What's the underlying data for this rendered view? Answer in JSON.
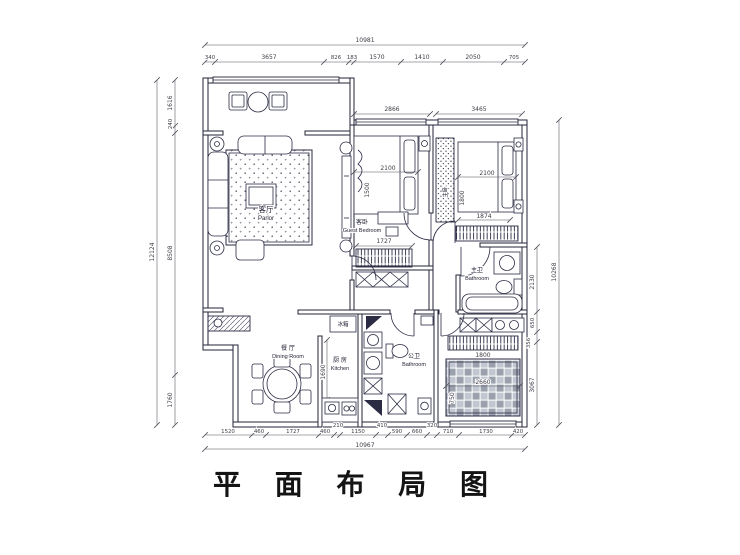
{
  "title": "平 面 布 局 图",
  "colors": {
    "line": "#23233a",
    "dim_text": "#3c3c46",
    "paper": "#ffffff",
    "tatami_dark": "#9aa1ac",
    "tatami_light": "#c2c8d2"
  },
  "rooms": {
    "parlor": {
      "zh": "客厅",
      "en": "Parlor"
    },
    "guest_bedroom": {
      "zh": "客卧",
      "en": "Guest Bedroom"
    },
    "master_bedroom": {
      "zh": "主卧"
    },
    "dining": {
      "zh": "餐 厅",
      "en": "Dining Room"
    },
    "kitchen": {
      "zh": "厨 房",
      "en": "Kitchen"
    },
    "guest_bath": {
      "zh": "公卫",
      "en": "Bathroom"
    },
    "master_bath": {
      "zh": "主卫",
      "en": "Bathroom"
    },
    "fridge_label": "冰箱"
  },
  "dims": {
    "top_total": "10981",
    "top": [
      "340",
      "3657",
      "826",
      "183",
      "1570",
      "1410",
      "2050",
      "705"
    ],
    "left_total": "12124",
    "left": [
      "1616",
      "240",
      "8508",
      "1760"
    ],
    "bottom_total": "10967",
    "bottom": [
      "1520",
      "460",
      "1727",
      "460",
      "210",
      "1150",
      "410",
      "590",
      "660",
      "320",
      "710",
      "1730",
      "420"
    ],
    "right_total": "10268",
    "right": [
      "2130",
      "650",
      "356",
      "3067"
    ],
    "inner": {
      "guest_room_w": "2866",
      "master_room_w": "3465",
      "guest_bed_w": "2100",
      "guest_bed_h": "1500",
      "master_bed_w": "2100",
      "master_bed_h": "1800",
      "master_bench": "1874",
      "wardrobe_w": "1727",
      "kitchen_h": "1690",
      "study_closet": "1800",
      "tatami_w": "2660",
      "tatami_h": "750"
    }
  }
}
